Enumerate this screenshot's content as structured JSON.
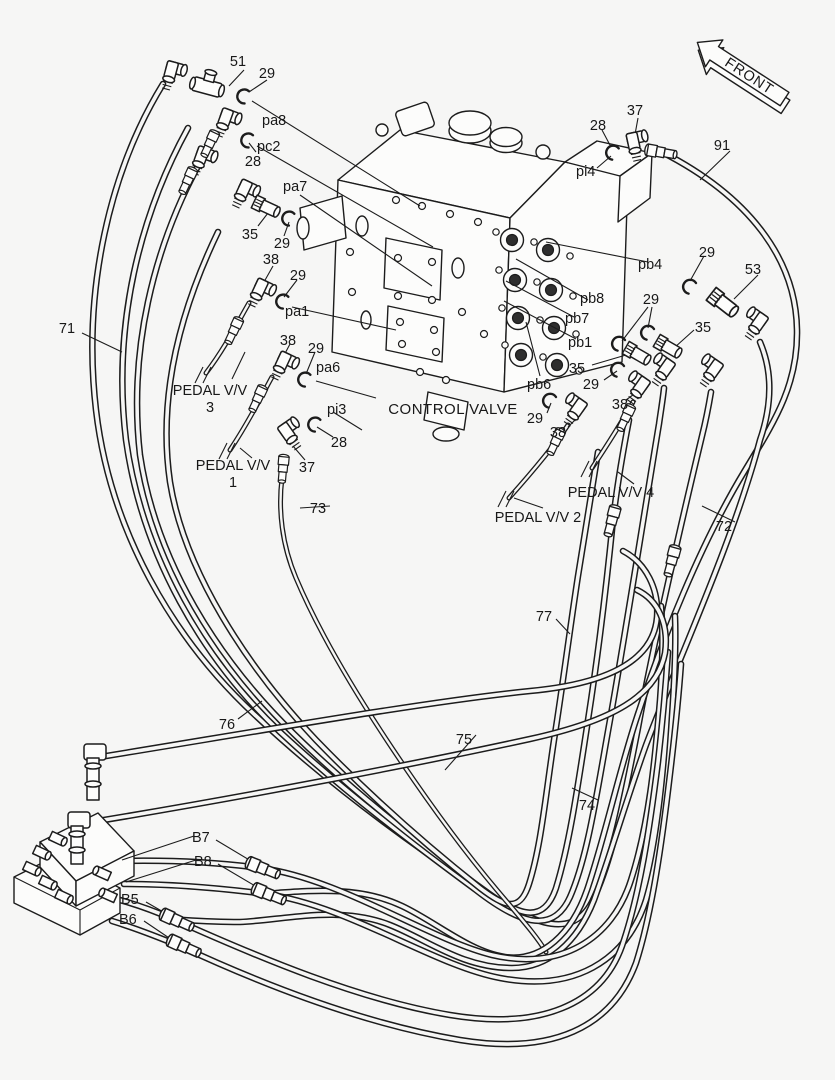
{
  "page": {
    "background_color": "#f6f6f5",
    "line_color": "#1c1c1c",
    "description": "Hydraulic pilot piping parts diagram around control valve"
  },
  "labels": {
    "control_valve": "CONTROL VALVE",
    "pedal_vv": "PEDAL V/V",
    "pedal3_num": "3",
    "pedal1_num": "1",
    "pedal4": "PEDAL V/V 4",
    "pedal2": "PEDAL V/V 2",
    "front": "FRONT"
  },
  "ports": {
    "pa8": "pa8",
    "pc2": "pc2",
    "pa7": "pa7",
    "pa1": "pa1",
    "pa6": "pa6",
    "pi3": "pi3",
    "pi4": "pi4",
    "pb4": "pb4",
    "pb8": "pb8",
    "pb7": "pb7",
    "pb1": "pb1",
    "pb6": "pb6",
    "b7": "B7",
    "b8": "B8",
    "b5": "B5",
    "b6": "B6"
  },
  "callouts": {
    "c51": "51",
    "c29_pa8": "29",
    "c28_pc2": "28",
    "c35_pa7": "35",
    "c29_pa7": "29",
    "c38_pa1": "38",
    "c29_pa1": "29",
    "c38_pa6": "38",
    "c29_pa6": "29",
    "c28_pi3": "28",
    "c37_pi3": "37",
    "c71": "71",
    "c73": "73",
    "c37_pi4": "37",
    "c28_pi4": "28",
    "c91": "91",
    "c29_pb4": "29",
    "c53": "53",
    "c29_pb87": "29",
    "c35_pb8": "35",
    "c35_pb1": "35",
    "c29_pb1": "29",
    "c38_p4": "38",
    "c29_pb6": "29",
    "c38_pb6": "38",
    "c72": "72",
    "c77": "77",
    "c76": "76",
    "c75": "75",
    "c74": "74"
  }
}
